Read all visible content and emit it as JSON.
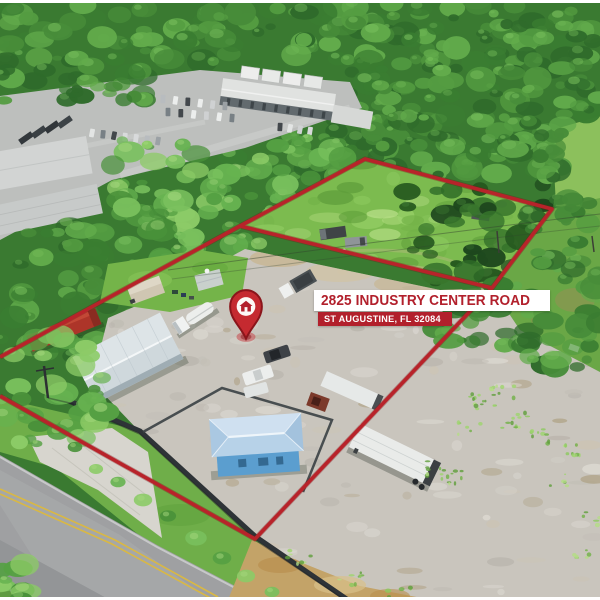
{
  "overlay": {
    "address_line1": "2825 INDUSTRY CENTER ROAD",
    "address_line2": "ST AUGUSTINE, FL 32084",
    "banner_bg": "#ffffff",
    "banner_text_color": "#b2202c",
    "subbanner_bg": "#b2202c",
    "subbanner_text_color": "#ffffff"
  },
  "marker": {
    "icon": "map-pin-house-icon",
    "pin_color": "#c52a30",
    "pin_outline_color": "#8a151b",
    "house_glyph_color": "#b2202c"
  },
  "boundary": {
    "color": "#b8232a"
  }
}
